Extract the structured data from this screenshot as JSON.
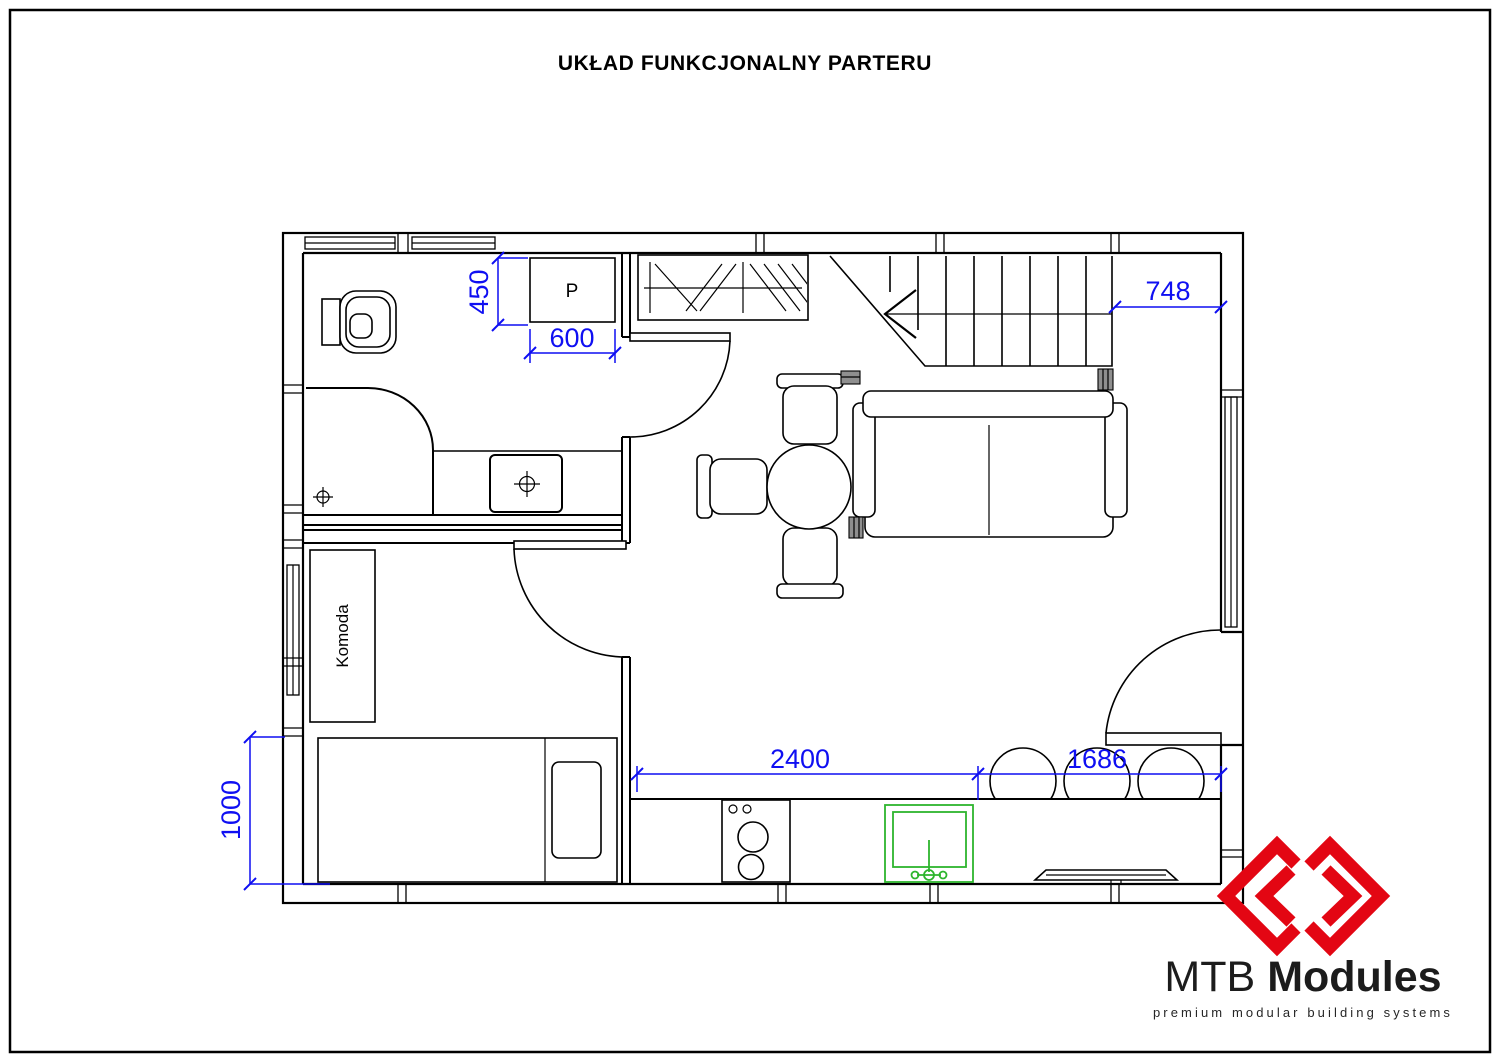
{
  "page": {
    "title": "UKŁAD FUNKCJONALNY PARTERU"
  },
  "plan": {
    "labels": {
      "washing_machine": "P",
      "dresser": "Komoda"
    },
    "dimensions": {
      "washer_depth": "450",
      "washer_width": "600",
      "stair_landing_width": "748",
      "kitchen_run": "2400",
      "kitchen_right_run": "1686",
      "bed_width": "1000"
    }
  },
  "logo": {
    "brand_prefix": "MTB",
    "brand_suffix": "Modules",
    "tagline": "premium modular building systems"
  },
  "colors": {
    "dimension-blue": "#0f0ff2",
    "sink-green": "#2db52d",
    "logo-red": "#e30613",
    "fixture-gray": "#8f8f8f"
  }
}
